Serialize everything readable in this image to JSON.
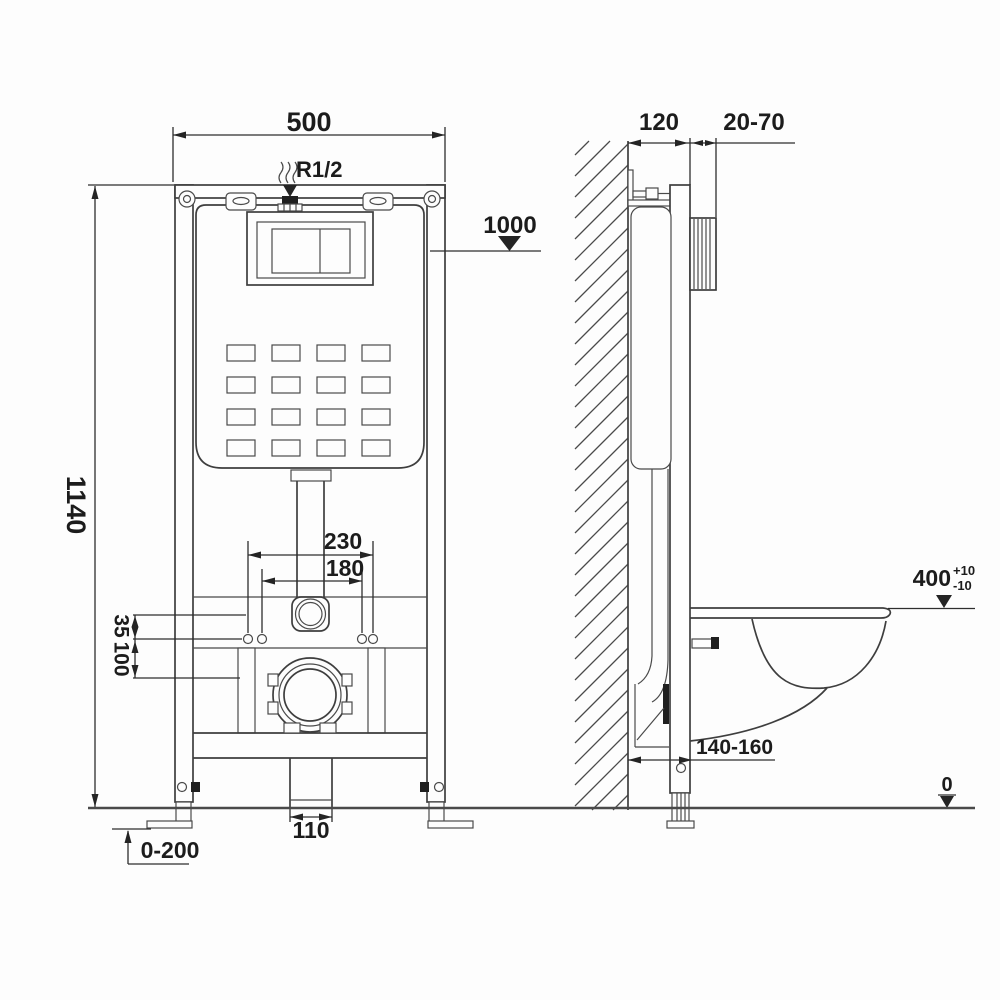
{
  "colors": {
    "background": "#fdfdfd",
    "line": "#3e3e3e",
    "dim_line": "#2e2e2e",
    "text": "#1c1c1c",
    "dark_fill": "#1f1f1f"
  },
  "front_view": {
    "frame_width": "500",
    "inlet_thread": "R1/2",
    "level_1000": "1000",
    "overall_height": "1140",
    "fixing_span_outer": "230",
    "fixing_span_inner": "180",
    "offset_35": "35",
    "offset_100": "100",
    "outlet_width": "110",
    "leg_adjust_range": "0-200"
  },
  "side_view": {
    "frame_depth": "120",
    "wall_finish_range": "20-70",
    "seat_height": "400",
    "seat_tol_plus": "+10",
    "seat_tol_minus": "-10",
    "outlet_distance": "140-160",
    "floor_level": "0"
  }
}
